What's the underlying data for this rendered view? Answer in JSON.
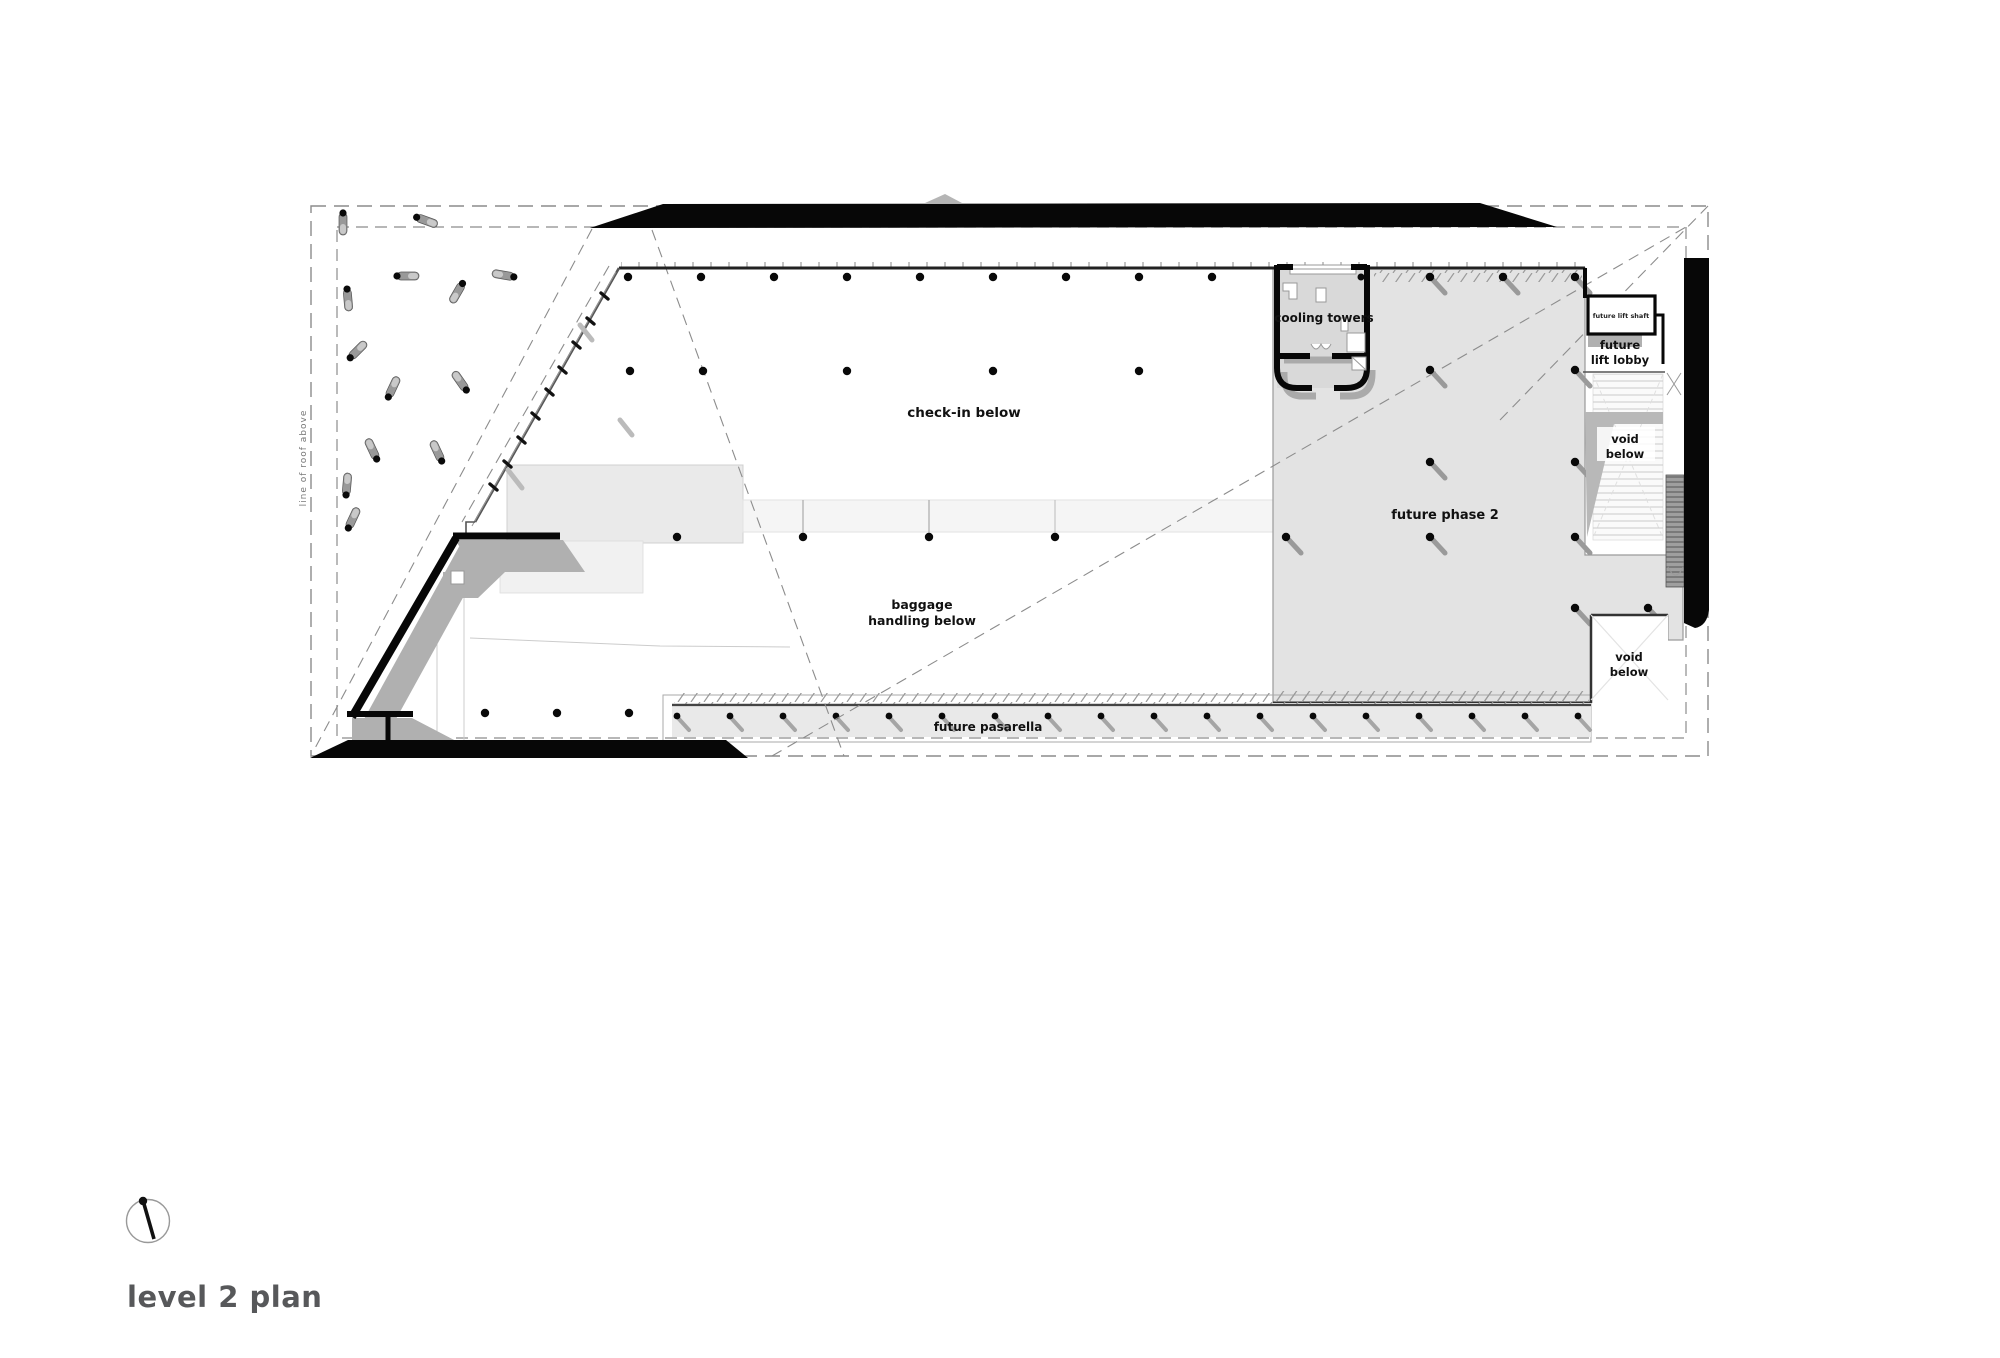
{
  "title": "level 2 plan",
  "icons": {
    "compass": "north-compass-icon"
  },
  "labels": {
    "roof_line": "line of roof above",
    "check_in": "check-in below",
    "cooling_towers": "cooling towers",
    "future_lift_shaft": "future lift shaft",
    "future_lift_lobby": {
      "l1": "future",
      "l2": "lift lobby"
    },
    "void_upper": {
      "l1": "void",
      "l2": "below"
    },
    "void_lower": {
      "l1": "void",
      "l2": "below"
    },
    "future_phase2": "future phase 2",
    "baggage": {
      "l1": "baggage",
      "l2": "handling below"
    },
    "future_pasarella": "future pasarella"
  },
  "colors": {
    "wall_black": "#0a0a0a",
    "shadow_gray": "#b0b0b0",
    "phase2_fill": "#e3e3e3",
    "slab_light": "#efefef",
    "dashed_line": "#8c8c8c",
    "title_text": "#57585a"
  }
}
